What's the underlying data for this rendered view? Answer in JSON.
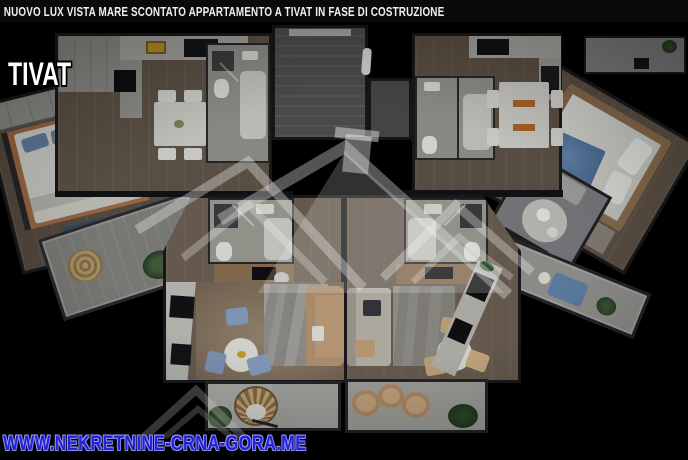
{
  "title_bar": {
    "text": "NUOVO LUX VISTA MARE SCONTATO APPARTAMENTO A TIVAT IN FASE DI COSTRUZIONE",
    "bg_color": "#0a0a0a",
    "text_color": "#f0f0f0"
  },
  "location_label": {
    "text": "TIVAT",
    "text_color": "#ffffff"
  },
  "footer_watermark": {
    "text": "WWW.NEKRETNINE-CRNA-GORA.ME",
    "text_color": "#2222d8",
    "outline_color": "#9a9af0"
  },
  "scene": {
    "type": "3d-floorplan-top-view-render",
    "center_watermark": "house-roofs-logo",
    "palette": {
      "background": "#000000",
      "walls": "#19191b",
      "wood_floor": "#6a5c4c",
      "white_fixture": "#d6d6d0",
      "blue_sofa": "#2d4a68",
      "blue_chair": "#7e9cc0",
      "tan_sofa": "#c19a71",
      "blue_blanket": "#4c7098",
      "rattan": "#c3a368",
      "plant_green": "#315031",
      "marble_rug": "#9a9a98",
      "accent_orange": "#b55f1e",
      "accent_yellow": "#c08e13"
    }
  }
}
